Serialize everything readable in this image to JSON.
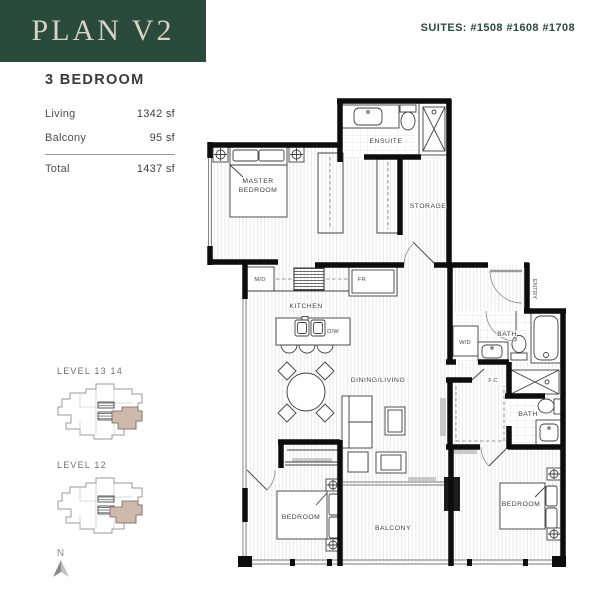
{
  "header": {
    "plan_label": "PLAN V2",
    "suites_label": "SUITES: #1508 #1608 #1708"
  },
  "summary": {
    "title": "3 BEDROOM",
    "rows": [
      {
        "label": "Living",
        "value": "1342 sf"
      },
      {
        "label": "Balcony",
        "value": "95 sf"
      }
    ],
    "total": {
      "label": "Total",
      "value": "1437 sf"
    }
  },
  "keyplans": [
    {
      "label": "LEVEL 13 14"
    },
    {
      "label": "LEVEL 12"
    }
  ],
  "compass": {
    "label": "N"
  },
  "plan": {
    "rooms": {
      "master_bedroom_line1": "MASTER",
      "master_bedroom_line2": "BEDROOM",
      "ensuite": "ENSUITE",
      "storage": "STORAGE",
      "kitchen": "KITCHEN",
      "dining_living": "DINING/LIVING",
      "bedroom_left": "BEDROOM",
      "bedroom_right": "BEDROOM",
      "balcony": "BALCONY",
      "bath_upper": "BATH",
      "bath_lower": "BATH",
      "entry": "ENTRY",
      "flex_closet": "F.C"
    },
    "appliances": {
      "washer_dryer": "W/D",
      "microwave": "M/D",
      "fridge": "FR",
      "dishwasher": "D/W"
    }
  },
  "colors": {
    "brand_green": "#2a4a3b",
    "cream_text": "#d9d3c3",
    "keyplan_highlight": "#cfb8ac",
    "wall_black": "#0d0d0d",
    "label_gray": "#3d3d3d"
  }
}
